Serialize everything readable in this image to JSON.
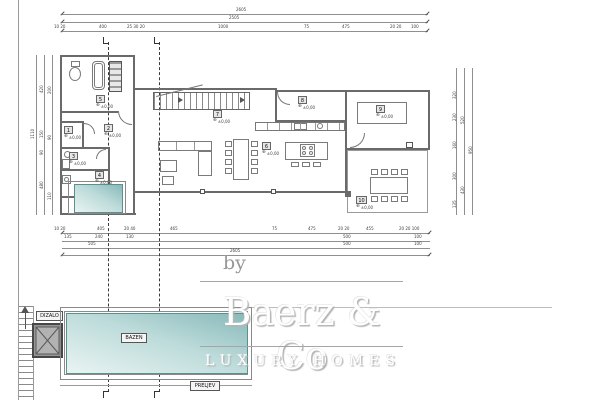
{
  "watermark": {
    "prefix": "by",
    "brand": "Baerz & Co",
    "tagline": "LUXURY HOMES"
  },
  "site_labels": {
    "elevator": "DIZALO",
    "pool": "BAZEN",
    "overflow": "PRELJEV"
  },
  "rooms": [
    {
      "number": "1",
      "elevation": "±0,00"
    },
    {
      "number": "2",
      "elevation": "±0,00"
    },
    {
      "number": "3",
      "elevation": "±0,00"
    },
    {
      "number": "4",
      "elevation": "±0,00"
    },
    {
      "number": "5",
      "elevation": "±0,00"
    },
    {
      "number": "6",
      "elevation": "±0,00"
    },
    {
      "number": "7",
      "elevation": "±0,00"
    },
    {
      "number": "8",
      "elevation": "±0,00"
    },
    {
      "number": "9",
      "elevation": "±0,00"
    },
    {
      "number": "10",
      "elevation": "±0,00"
    }
  ],
  "dims": {
    "top_total_a": "2605",
    "top_total_b": "2505",
    "top_row": [
      "10 20",
      "400",
      "25 30 20",
      "1000",
      "75",
      "475",
      "20 20",
      "100"
    ],
    "bottom_row1": [
      "10 20",
      "405",
      "20 40",
      "465",
      "75",
      "475",
      "20 20",
      "455",
      "20 20 100"
    ],
    "bottom_row2": [
      "135",
      "240",
      "130",
      "500",
      "100"
    ],
    "bottom_row3": [
      "505",
      "500",
      "100"
    ],
    "bottom_total": "2605",
    "left_total": "1110",
    "left_col1": [
      "420",
      "150",
      "90",
      "480"
    ],
    "left_col2": [
      "200",
      "90",
      "110"
    ],
    "right_col1": [
      "320",
      "230",
      "160",
      "300",
      "135"
    ],
    "right_col2": [
      "520",
      "430"
    ],
    "right_total": "950"
  },
  "colors": {
    "pool_dark": "#88b9b9",
    "pool_light": "#e9f4f2",
    "wall": "#6a6a6a",
    "watermark_shadow": "#b5b5b5"
  }
}
